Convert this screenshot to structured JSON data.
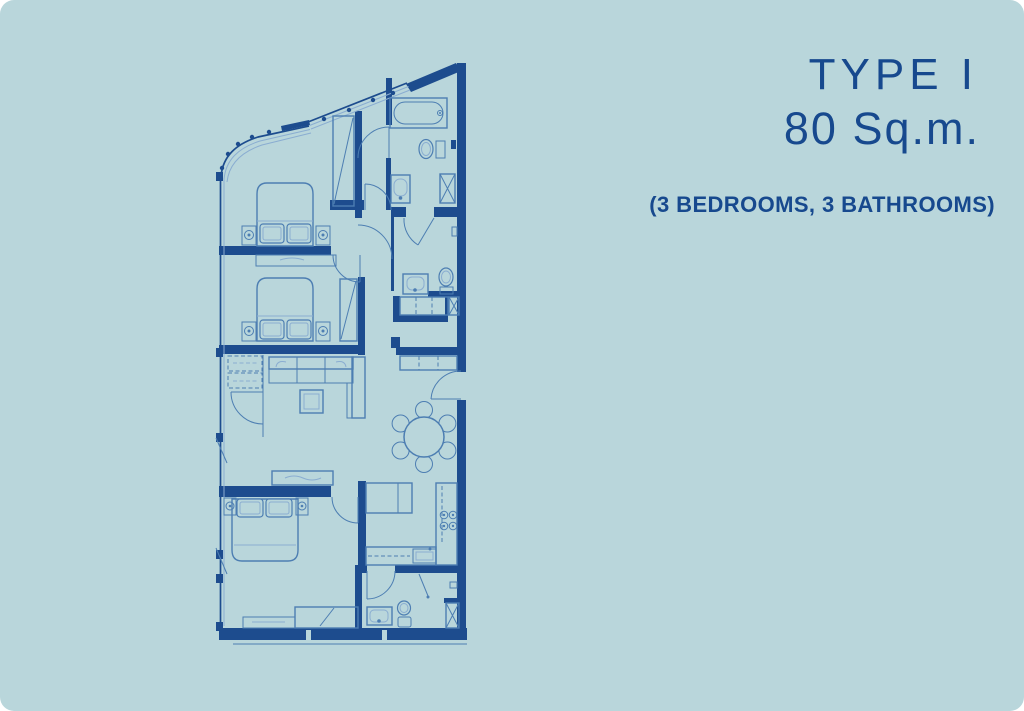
{
  "card": {
    "background": "#b9d6db",
    "corner_radius_px": 14
  },
  "colors": {
    "background": "#b9d6db",
    "wall_navy": "#1d4c8e",
    "furniture_line_blue": "#4d7eb2",
    "light_line_blue": "#8aadd1",
    "text_navy": "#17498e"
  },
  "title_block": {
    "type_label": "TYPE I",
    "area_label": "80 Sq.m.",
    "configuration_label": "(3 BEDROOMS, 3 BATHROOMS)"
  },
  "floor_plan": {
    "kind": "architectural-floor-plan",
    "rooms": [
      {
        "name": "bedroom-1",
        "fixtures": [
          "double-bed",
          "nightstands",
          "walk-in-wardrobe",
          "dresser"
        ]
      },
      {
        "name": "bathroom-1",
        "fixtures": [
          "bathtub",
          "toilet",
          "washbasin",
          "shower"
        ]
      },
      {
        "name": "bedroom-2",
        "fixtures": [
          "double-bed",
          "nightstands",
          "wardrobe"
        ]
      },
      {
        "name": "bathroom-2",
        "fixtures": [
          "washbasin",
          "toilet",
          "linen-closet",
          "shower"
        ]
      },
      {
        "name": "living-room",
        "fixtures": [
          "sofa",
          "chaise",
          "coffee-table",
          "tv-console",
          "closet"
        ]
      },
      {
        "name": "dining-area",
        "fixtures": [
          "round-dining-table",
          "six-chairs"
        ]
      },
      {
        "name": "kitchen",
        "fixtures": [
          "island-counter",
          "counter",
          "stove-4-burners",
          "kitchen-sink"
        ]
      },
      {
        "name": "bedroom-3",
        "fixtures": [
          "double-bed",
          "nightstands",
          "wardrobe",
          "low-cabinet"
        ]
      },
      {
        "name": "bathroom-3",
        "fixtures": [
          "washbasin",
          "toilet",
          "shower"
        ]
      },
      {
        "name": "foyer",
        "fixtures": [
          "entrance-door",
          "shoe-cabinet"
        ]
      }
    ]
  }
}
